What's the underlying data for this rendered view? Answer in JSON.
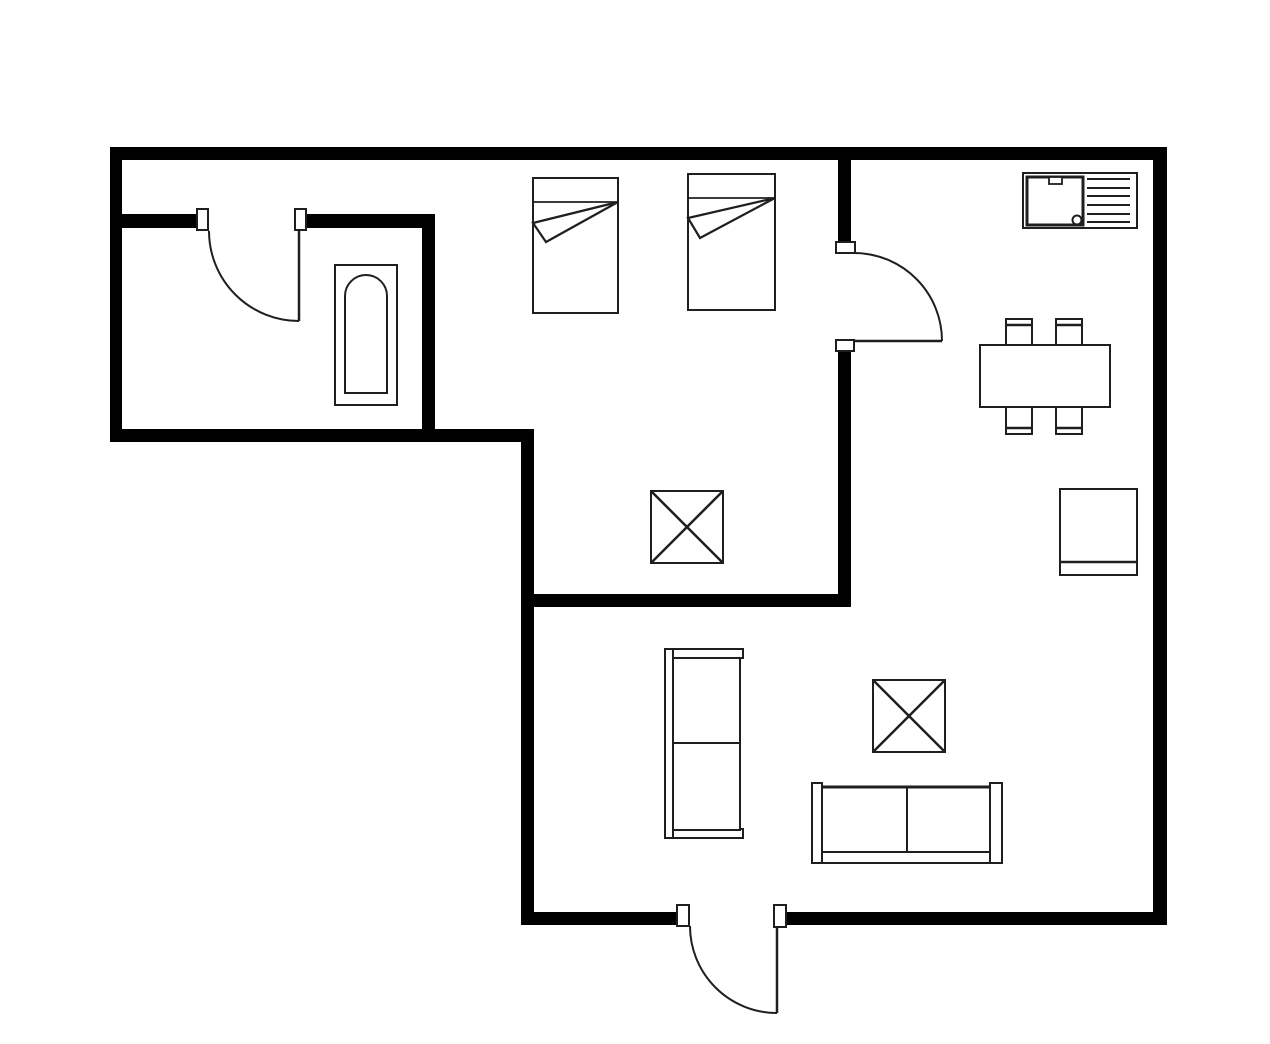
{
  "canvas": {
    "width": 1270,
    "height": 1044,
    "background": "#ffffff",
    "wall_color": "#000000",
    "line_color": "#1f1f1f",
    "fixture_fill": "#ffffff"
  },
  "walls": [
    {
      "name": "wall-outer-top",
      "x": 110,
      "y": 147,
      "w": 1057,
      "h": 13
    },
    {
      "name": "wall-outer-left",
      "x": 110,
      "y": 147,
      "w": 12,
      "h": 295
    },
    {
      "name": "wall-bath-bottom",
      "x": 110,
      "y": 429,
      "w": 423,
      "h": 13
    },
    {
      "name": "wall-living-left",
      "x": 521,
      "y": 429,
      "w": 13,
      "h": 496
    },
    {
      "name": "wall-bottom-west",
      "x": 521,
      "y": 912,
      "w": 168,
      "h": 13
    },
    {
      "name": "wall-bottom-east",
      "x": 786,
      "y": 912,
      "w": 381,
      "h": 13
    },
    {
      "name": "wall-outer-right",
      "x": 1153,
      "y": 147,
      "w": 14,
      "h": 778
    },
    {
      "name": "wall-bath-top-west",
      "x": 122,
      "y": 214,
      "w": 76,
      "h": 14
    },
    {
      "name": "wall-bath-top-east",
      "x": 306,
      "y": 214,
      "w": 129,
      "h": 14
    },
    {
      "name": "wall-bath-right",
      "x": 422,
      "y": 214,
      "w": 13,
      "h": 215
    },
    {
      "name": "wall-bedroom-east-upper",
      "x": 838,
      "y": 159,
      "w": 13,
      "h": 84
    },
    {
      "name": "wall-bedroom-east-lower",
      "x": 838,
      "y": 350,
      "w": 13,
      "h": 257
    },
    {
      "name": "wall-bedroom-south",
      "x": 533,
      "y": 594,
      "w": 317,
      "h": 13
    }
  ],
  "door_jambs": [
    {
      "name": "jamb-bathroom-left",
      "x": 197,
      "y": 209,
      "w": 11,
      "h": 21
    },
    {
      "name": "jamb-bathroom-right",
      "x": 295,
      "y": 209,
      "w": 11,
      "h": 21
    },
    {
      "name": "jamb-kitchen-top",
      "x": 836,
      "y": 242,
      "w": 19,
      "h": 11
    },
    {
      "name": "jamb-kitchen-bottom",
      "x": 836,
      "y": 340,
      "w": 18,
      "h": 11
    },
    {
      "name": "jamb-entry-left",
      "x": 677,
      "y": 905,
      "w": 12,
      "h": 21
    },
    {
      "name": "jamb-entry-right",
      "x": 774,
      "y": 905,
      "w": 12,
      "h": 22
    }
  ],
  "doors": [
    {
      "name": "door-bathroom",
      "leaf": {
        "x1": 299,
        "y1": 230,
        "x2": 299,
        "y2": 321
      },
      "swing": "M 209 231 A 90 90 0 0 0 299 321"
    },
    {
      "name": "door-kitchen",
      "leaf": {
        "x1": 854,
        "y1": 341,
        "x2": 942,
        "y2": 341
      },
      "swing": "M 855 253 A 88 88 0 0 1 942 341"
    },
    {
      "name": "door-entry",
      "leaf": {
        "x1": 777,
        "y1": 926,
        "x2": 777,
        "y2": 1013
      },
      "swing": "M 690 926 A 87 87 0 0 0 777 1013"
    }
  ],
  "furniture": [
    {
      "type": "bathtub",
      "name": "bathtub",
      "outer": [
        335,
        265,
        62,
        140
      ],
      "inner": [
        345,
        275,
        42,
        118
      ],
      "corner_radius": 21
    },
    {
      "type": "bed",
      "name": "bed-1",
      "rect": [
        533,
        178,
        85,
        135
      ],
      "pillow_y": 202,
      "fold": [
        [
          618,
          202
        ],
        [
          533,
          223
        ],
        [
          546,
          242
        ]
      ]
    },
    {
      "type": "bed",
      "name": "bed-2",
      "rect": [
        688,
        174,
        87,
        136
      ],
      "pillow_y": 198,
      "fold": [
        [
          775,
          198
        ],
        [
          688,
          218
        ],
        [
          700,
          238
        ]
      ]
    },
    {
      "type": "sink",
      "name": "kitchen-sink",
      "outer": [
        1023,
        173,
        114,
        55
      ],
      "basin": [
        1027,
        177,
        56,
        48
      ],
      "faucet": [
        1049,
        177,
        13,
        7
      ],
      "drain": [
        1077,
        220,
        4.5
      ],
      "board_x1": 1087,
      "board_x2": 1130,
      "board_ys": [
        179,
        188,
        196,
        205,
        214,
        222
      ]
    },
    {
      "type": "table",
      "name": "dining-table",
      "rect": [
        980,
        345,
        130,
        62
      ]
    },
    {
      "type": "chair",
      "name": "dining-chair-nw",
      "rect": [
        1006,
        319,
        26,
        26
      ],
      "back_y": 325
    },
    {
      "type": "chair",
      "name": "dining-chair-ne",
      "rect": [
        1056,
        319,
        26,
        26
      ],
      "back_y": 325
    },
    {
      "type": "chair",
      "name": "dining-chair-sw",
      "rect": [
        1006,
        407,
        26,
        27
      ],
      "back_y": 428
    },
    {
      "type": "chair",
      "name": "dining-chair-se",
      "rect": [
        1056,
        407,
        26,
        27
      ],
      "back_y": 428
    },
    {
      "type": "xtable",
      "name": "bedroom-side-table",
      "rect": [
        651,
        491,
        72,
        72
      ]
    },
    {
      "type": "chair",
      "name": "armchair",
      "rect": [
        1060,
        489,
        77,
        86
      ],
      "back_y": 562
    },
    {
      "type": "cabinet",
      "name": "wardrobe",
      "caps": [
        [
          665,
          649,
          78,
          9
        ],
        [
          665,
          829,
          78,
          9
        ]
      ],
      "side": [
        665,
        649,
        8,
        189
      ],
      "body": [
        673,
        658,
        67,
        172
      ],
      "divider_y": 743
    },
    {
      "type": "xtable",
      "name": "living-room-table",
      "rect": [
        873,
        680,
        72,
        72
      ]
    },
    {
      "type": "sofa",
      "name": "sofa",
      "arms": [
        [
          812,
          783,
          10,
          80
        ],
        [
          990,
          783,
          12,
          80
        ]
      ],
      "base": [
        812,
        852,
        190,
        11
      ],
      "seat": [
        822,
        787,
        168,
        65
      ],
      "divider_x": 907
    }
  ]
}
